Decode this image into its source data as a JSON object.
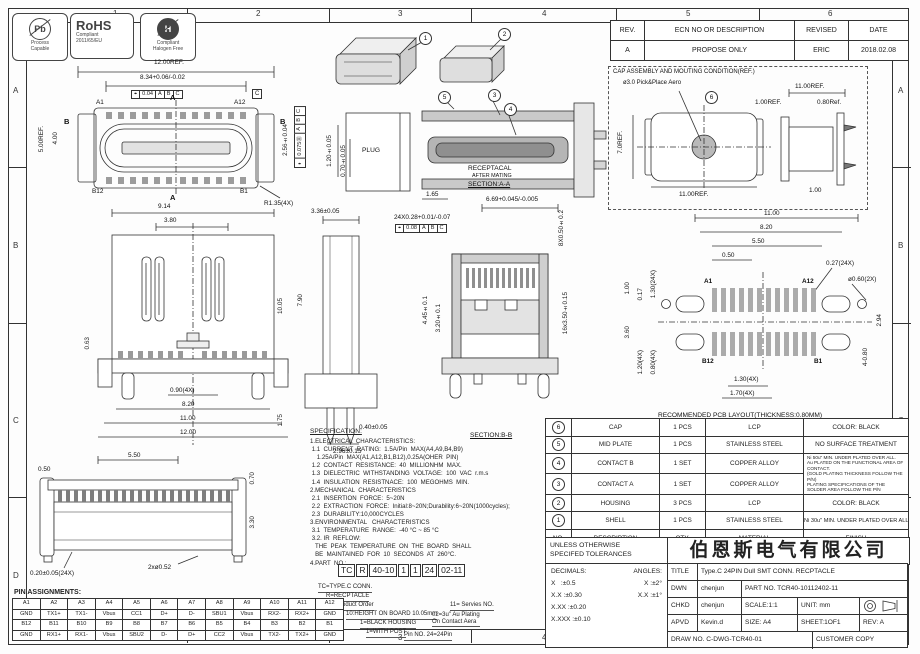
{
  "zones": {
    "cols": [
      "1",
      "2",
      "3",
      "4",
      "5",
      "6"
    ],
    "rows": [
      "A",
      "B",
      "C",
      "D"
    ]
  },
  "logos": {
    "pb": "Pb",
    "pb_caption": "Process\nCapable",
    "rohs": "RoHS",
    "rohs_line1": "Compliant",
    "rohs_line2": "2011/65/EU",
    "halogen": "H",
    "hal_line1": "Compliant",
    "hal_line2": "Halogen Free"
  },
  "revision_table": {
    "headers": [
      "REV.",
      "ECN NO OR DESCRIPTION",
      "REVISED",
      "DATE"
    ],
    "rows": [
      [
        "A",
        "PROPOSE ONLY",
        "ERIC",
        "2018.02.08"
      ]
    ]
  },
  "callouts": {
    "n1": "1",
    "n2": "2",
    "n3": "3",
    "n4": "4",
    "n5": "5",
    "n6": "6"
  },
  "fcf": {
    "plan": [
      "⌖",
      "0.04",
      "A",
      "B",
      "C"
    ],
    "plan_v": [
      "⌖",
      "0.075Ⓜ",
      "A",
      "B",
      "C"
    ],
    "bb": [
      "⌖",
      "0.08",
      "A",
      "B",
      "C"
    ]
  },
  "labels": {
    "plug": "PLUG",
    "receptacal": "RECEPTACAL",
    "after_mating": "AFTER MATING",
    "section_aa": "SECTION:A-A",
    "section_bb": "SECTION:B-B",
    "a1": "A1",
    "a12": "A12",
    "b12": "B12",
    "b1": "B1",
    "a": "A",
    "b": "B",
    "datum_c": "C",
    "pcb_a1": "A1",
    "pcb_a12": "A12",
    "pcb_b12": "B12",
    "pcb_b1": "B1",
    "pcb_cap1": "RECOMMENDED PCB LAYOUT(THICKNESS:0.80MM)",
    "pcb_cap2": "PWB TOLERANCE: ±0.05",
    "cap_title": "CAP ASSEMBLY AND MOUTING CONDITION(REF.)",
    "cap_pick": "ø3.0 Pick&Place Aero"
  },
  "dims": {
    "plan_w": "12.00REF.",
    "plan_inner": "8.34+0.06/-0.02",
    "plan_h": "5.00REF.",
    "plan_h2": "4.00",
    "plan_pitch": "2.56±0.04",
    "plan_r": "R1.35(4X)",
    "aa_120": "1.20±0.05",
    "aa_070": "0.70±0.05",
    "aa_165": "1.65",
    "bb_669": "6.69+0.045/-0.005",
    "bb_pads": "24X0.28+0.01/-0.07",
    "bb_8x": "8X0.50±0.2",
    "bb_445": "4.45±0.1",
    "bb_320": "3.20±0.1",
    "bb_16x": "16x3.50±0.15",
    "fr_914": "9.14",
    "fr_380": "3.80",
    "fr_063": "0.63",
    "fr_090": "0.90(4X)",
    "fr_820": "8.20",
    "fr_1100": "11.00",
    "fr_1200": "12.00",
    "sd_336": "3.36±0.05",
    "sd_1005": "10.05",
    "sd_790": "7.90",
    "sd_175": "1.75",
    "sd_040": "0.40±0.05",
    "sd_296": "2.96±0.15",
    "pcb_1100": "11.00",
    "pcb_820": "8.20",
    "pcb_550": "5.50",
    "pcb_050": "0.50",
    "pcb_027": "0.27(24X)",
    "pcb_060": "ø0.60(2X)",
    "pcb_100": "1.00",
    "pcb_017": "0.17",
    "pcb_130a": "1.30(24X)",
    "pcb_360": "3.60",
    "pcb_120": "1.20(4X)",
    "pcb_080": "0.80(4X)",
    "pcb_130b": "1.30(4X)",
    "pcb_170": "1.70(4X)",
    "pcb_294": "2.94",
    "pcb_480": "4-0.80",
    "cap_70": "7.0REF.",
    "cap_1100b": "11.00REF.",
    "cap_100ref": "1.00REF.",
    "cap_1100t": "11.00REF.",
    "cap_080": "0.80Ref.",
    "cap_100": "1.00",
    "bt_550": "5.50",
    "bt_050": "0.50",
    "bt_070": "0.70",
    "bt_330": "3.30",
    "bt_020": "0.20±0.05(24X)",
    "bt_052": "2xø0.52"
  },
  "specification": {
    "title": "SPECIFICATION:",
    "lines": [
      "1.ELECTRICAL  CHARACTERISTICS:",
      " 1.1  CURRENT  RATING:  1.5A/Pin  MAX(A4,A9,B4,B9)",
      "    1.25A/Pin  MAX(A1,A12,B1,B12),0.25A(OHER  PIN)",
      " 1.2  CONTACT  RESISTANCE:  40  MILLIONHM  MAX.",
      " 1.3  DIELECTRIC  WITHSTANDING  VOLTAGE:  100  VAC  r.m.s",
      " 1.4  INSULATION  RESISTNACE:  100  MEGOHMS  MIN.",
      "2.MECHANICAL  CHARACTERISTICS",
      " 2.1  INSERTION  FORCE:  5~20N",
      " 2.2  EXTRACTION  FORCE:  Initial:8~20N;Durability:6~20N(1000cycles);",
      " 2.3  DURABILITY:10,000CYCLES",
      "3.ENVIRONMENTAL   CHARACTERISTICS",
      " 3.1  TEMPERATURE  RANGE:  -40 °C ~ 85 °C",
      " 3.2. IR  REFLOW:",
      "   THE  PEAK  TEMPERATURE  ON  THE  BOARD  SHALL",
      "   BE  MAINTAINED  FOR  10  SECONDS  AT  260°C.",
      "4.PART  NO.:"
    ]
  },
  "part_number": {
    "segments": [
      "TC",
      "R",
      "40-10",
      "1",
      "1",
      "24",
      "02-11"
    ],
    "l1": "TC=TYPE.C CONN.",
    "l2": "R=RECPTACLE",
    "l3": "Product Order",
    "l4": "10:HEIGHT ON BOARD 10.05mm",
    "l5": "1=BLACK HOUSING",
    "l6": "1=WITH POST",
    "r1": "11= Servies NO.",
    "r2": "02=3u\" Au Plating\nOn Contact Aera",
    "r3": "Pin NO. 24=24Pin"
  },
  "pin_table": {
    "title": "PIN ASSIGNMENTS:",
    "rows": [
      [
        "A1",
        "A2",
        "A3",
        "A4",
        "A5",
        "A6",
        "A7",
        "A8",
        "A9",
        "A10",
        "A11",
        "A12"
      ],
      [
        "GND",
        "TX1+",
        "TX1-",
        "Vbus",
        "CC1",
        "D+",
        "D-",
        "SBU1",
        "Vbus",
        "RX2-",
        "RX2+",
        "GND"
      ],
      [
        "B12",
        "B11",
        "B10",
        "B9",
        "B8",
        "B7",
        "B6",
        "B5",
        "B4",
        "B3",
        "B2",
        "B1"
      ],
      [
        "GND",
        "RX1+",
        "RX1-",
        "Vbus",
        "SBU2",
        "D-",
        "D+",
        "CC2",
        "Vbus",
        "TX2-",
        "TX2+",
        "GND"
      ]
    ]
  },
  "bom": {
    "headers": {
      "no": "NO.",
      "desc": "DESCRIPTION",
      "qty": "QTY.",
      "mat": "MATERIAL",
      "finish": "FINISH"
    },
    "rows": [
      {
        "no": "6",
        "desc": "CAP",
        "qty": "1  PCS",
        "mat": "LCP",
        "finish": "COLOR:  BLACK"
      },
      {
        "no": "5",
        "desc": "MID  PLATE",
        "qty": "1  PCS",
        "mat": "STAINLESS  STEEL",
        "finish": "NO  SURFACE  TREATMENT"
      },
      {
        "no": "4",
        "desc": "CONTACT  B",
        "qty": "1  SET",
        "mat": "COPPER  ALLOY"
      },
      {
        "no": "3",
        "desc": "CONTACT  A",
        "qty": "1  SET",
        "mat": "COPPER  ALLOY"
      },
      {
        "no": "2",
        "desc": "HOUSING",
        "qty": "3  PCS",
        "mat": "LCP",
        "finish": "COLOR:  BLACK"
      },
      {
        "no": "1",
        "desc": "SHELL",
        "qty": "1  PCS",
        "mat": "STAINLESS  STEEL",
        "finish": "Ni  30u\"  MIN.  UNDER  PLATED  OVER  ALL."
      }
    ],
    "contact_finish": "Ni 50u\" MIN. UNDER PLATED OVER ALL.\nAu PLATED ON THE FUNCTIONAL AREA OF CONTACT.\n(GOLD PLATING THICKNESS FOLLOW THE P/N)\nPLATING SPECIFICATIONS OF THE SOLDER AREA FOLLOW THE P/N"
  },
  "tolerance_block": {
    "unless1": "UNLESS  OTHERWISE",
    "unless2": "SPECIFED  TOLERANCES",
    "decimals_label": "DECIMALS:",
    "angles_label": "ANGLES:",
    "d1a": "X",
    "d1b": ":±0.5",
    "a1a": "X",
    "a1b": ":±2°",
    "d2a": "X.X",
    "d2b": ":±0.30",
    "a2a": "X.X",
    "a2b": ":±1°",
    "d3a": "X.XX",
    "d3b": ":±0.20",
    "d4a": "X.XXX",
    "d4b": ":±0.10"
  },
  "title_block": {
    "company": "伯恩斯电气有限公司",
    "title_label": "TITLE",
    "title": "Type.C  24PIN  Dull  SMT    CONN.  RECPTACLE",
    "dwn_label": "DWN",
    "dwn": "chenjun",
    "part_no": "PART  NO.  TCR40-10112402-11",
    "chkd_label": "CHKD",
    "chkd": "chenjun",
    "scale": "SCALE:1:1",
    "unit": "UNIT:   mm",
    "apvd_label": "APVD",
    "apvd": "Kevin.d",
    "size": "SIZE:  A4",
    "sheet": "SHEET:1OF1",
    "rev": "REV:  A",
    "draw_no": "DRAW  NO.  C-DWG-TCR40-01",
    "copy": "CUSTOMER  COPY"
  }
}
